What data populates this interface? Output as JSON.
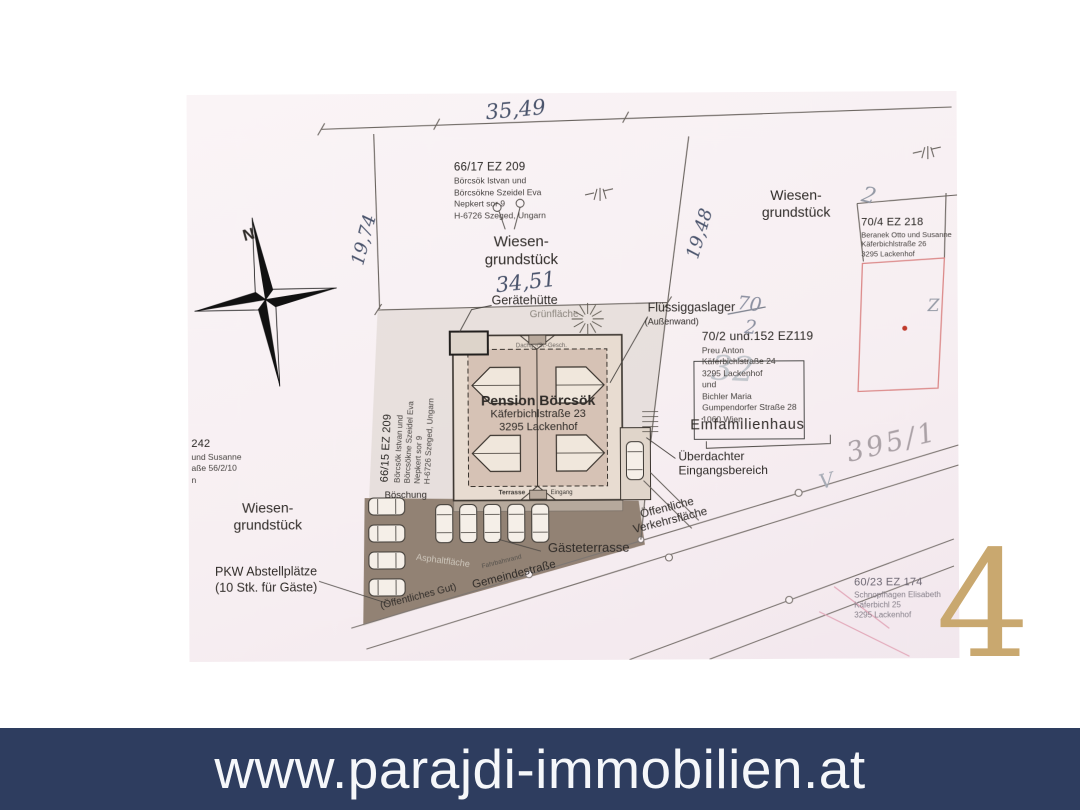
{
  "banner": {
    "url": "www.parajdi-immobilien.at"
  },
  "watermark": {
    "digit": "4"
  },
  "plan": {
    "compass": {
      "n": "N"
    },
    "dims": {
      "top": "35,49",
      "left": "19,74",
      "right": "19,48",
      "width": "34,51"
    },
    "marks": {
      "fr_top": "70",
      "fr_bot": "2",
      "ghost": "32",
      "two": "2",
      "zee": "Z",
      "vee": "V",
      "parcel_395": "395/1"
    },
    "meadow": {
      "l1": "Wiesen-",
      "l2": "grundstück"
    },
    "parcels": {
      "p6617": {
        "id": "66/17 EZ 209",
        "lines": [
          "Börcsök Istvan und",
          "Börcsökne Szeidel Eva",
          "Nepkert sor 9",
          "H-6726 Szeged, Ungarn"
        ]
      },
      "p6615": {
        "id": "66/15 EZ 209",
        "lines": [
          "Börcsök Istvan und",
          "Börcsökne Szeidel Eva",
          "Nepkert sor 9",
          "H-6726 Szeged, Ungarn"
        ]
      },
      "p704": {
        "id": "70/4 EZ 218",
        "lines": [
          "Beranek Otto und Susanne",
          "Käferbichlstraße 26",
          "3295 Lackenhof"
        ]
      },
      "p702": {
        "id": "70/2 und.152 EZ119",
        "lines": [
          "Preu Anton",
          "Käferbichlstraße 24",
          "3295 Lackenhof",
          "und",
          "Bichler Maria",
          "Gumpendorfer Straße 28",
          "1060 Wien"
        ]
      },
      "p6023": {
        "id": "60/23 EZ 174",
        "lines": [
          "Schnopfhagen Elisabeth",
          "Käferbichl 25",
          "3295 Lackenhof"
        ]
      },
      "pleft": {
        "id": "242",
        "lines": [
          "und Susanne",
          "aße 56/2/10",
          "n"
        ]
      }
    },
    "building": {
      "name": "Pension Börcsök",
      "street": "Käferbichlstraße 23",
      "city": "3295 Lackenhof",
      "roof_note": "Dachg.-/St.-Gesch.",
      "terrace": "Terrasse",
      "entry": "Eingang"
    },
    "labels": {
      "geraetehuette": "Gerätehütte",
      "gruenflaeche": "Grünfläche",
      "fluessiggaslager": "Flüssiggaslager",
      "aussenwand": "(Außenwand)",
      "einfamilienhaus": "Einfamilienhaus",
      "ueberdachter": "Überdachter",
      "eingangsbereich": "Eingangsbereich",
      "boeschung": "Böschung",
      "asphaltflaeche": "Asphaltfläche",
      "fahrbahnrand": "Fahrbahnrand",
      "gaesteterrasse": "Gästeterrasse",
      "pkw1": "PKW Abstellplätze",
      "pkw2": "(10 Stk. für Gäste)",
      "gemeindestrasse": "Gemeindestraße",
      "oeffentliches_gut": "(Öffentliches Gut)",
      "oeffentliche": "Öffentliche",
      "verkehrsflaeche": "Verkehrsfläche"
    }
  }
}
